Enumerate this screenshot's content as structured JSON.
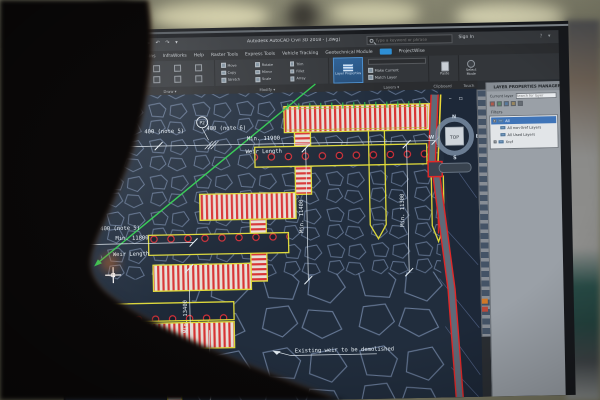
{
  "window": {
    "title": "Autodesk AutoCAD Civil 3D 2018 - [.dwg]",
    "search_placeholder": "Type a keyword or phrase",
    "sign_in": "Sign In"
  },
  "ribbon": {
    "tabs": [
      {
        "label": "Add-ins"
      },
      {
        "label": "InfraWorks"
      },
      {
        "label": "Help"
      },
      {
        "label": "Raster Tools"
      },
      {
        "label": "Express Tools"
      },
      {
        "label": "Vehicle Tracking"
      },
      {
        "label": "Geotechnical Module"
      },
      {
        "label": "ProjectWise"
      }
    ],
    "modify_tools": [
      "Move",
      "Copy",
      "Stretch",
      "Rotate",
      "Mirror",
      "Scale",
      "Trim",
      "Fillet",
      "Array"
    ],
    "layer_properties": "Layer Properties",
    "make_current": "Make Current",
    "match_layer": "Match Layer",
    "paste": "Paste",
    "select_mode": "Select Mode",
    "panels": {
      "draw": {
        "label": "Draw ▾"
      },
      "modify": {
        "label": "Modify ▾"
      },
      "layers": {
        "label": "Layers ▾"
      },
      "clipboard": {
        "label": "Clipboard"
      },
      "touch": {
        "label": "Touch"
      }
    }
  },
  "canvas": {
    "annotations": {
      "p2": "P2",
      "note6": "400 (note 6)",
      "note5_top": "400 (note 5)",
      "note5_left": "400 (note 5)",
      "min_11900": "Min. 11900",
      "weir_length_top": "Weir Length",
      "min_11800": "Min. 11800",
      "weir_length_left": "Weir Length",
      "min_13400": "Min. 13400",
      "min_6100": "Min. 6100",
      "min_11400": "Min. 11400",
      "min_11300": "Min. 11300",
      "demolish_note": "Existing weir to be demolished"
    },
    "viewcube": {
      "top": "TOP",
      "north": "N",
      "east": "E",
      "south": "S",
      "west": "W"
    },
    "colors": {
      "canvas_bg": "#212d3d",
      "wall_yellow": "#ddd83a",
      "hatch_red": "#d83434",
      "dimension_white": "#e9f1f7",
      "green_line": "#2ec84e",
      "alignment_red": "#e02828",
      "stone_outline": "#6e81a0"
    }
  },
  "layer_panel": {
    "title": "LAYER PROPERTIES MANAGER",
    "current_layer": "Current layer",
    "search_placeholder": "Search for layer",
    "filters": "Filters",
    "tree": [
      {
        "label": "All"
      },
      {
        "label": "All non-Xref Layers"
      },
      {
        "label": "All Used Layers"
      },
      {
        "label": "Xref"
      }
    ]
  }
}
